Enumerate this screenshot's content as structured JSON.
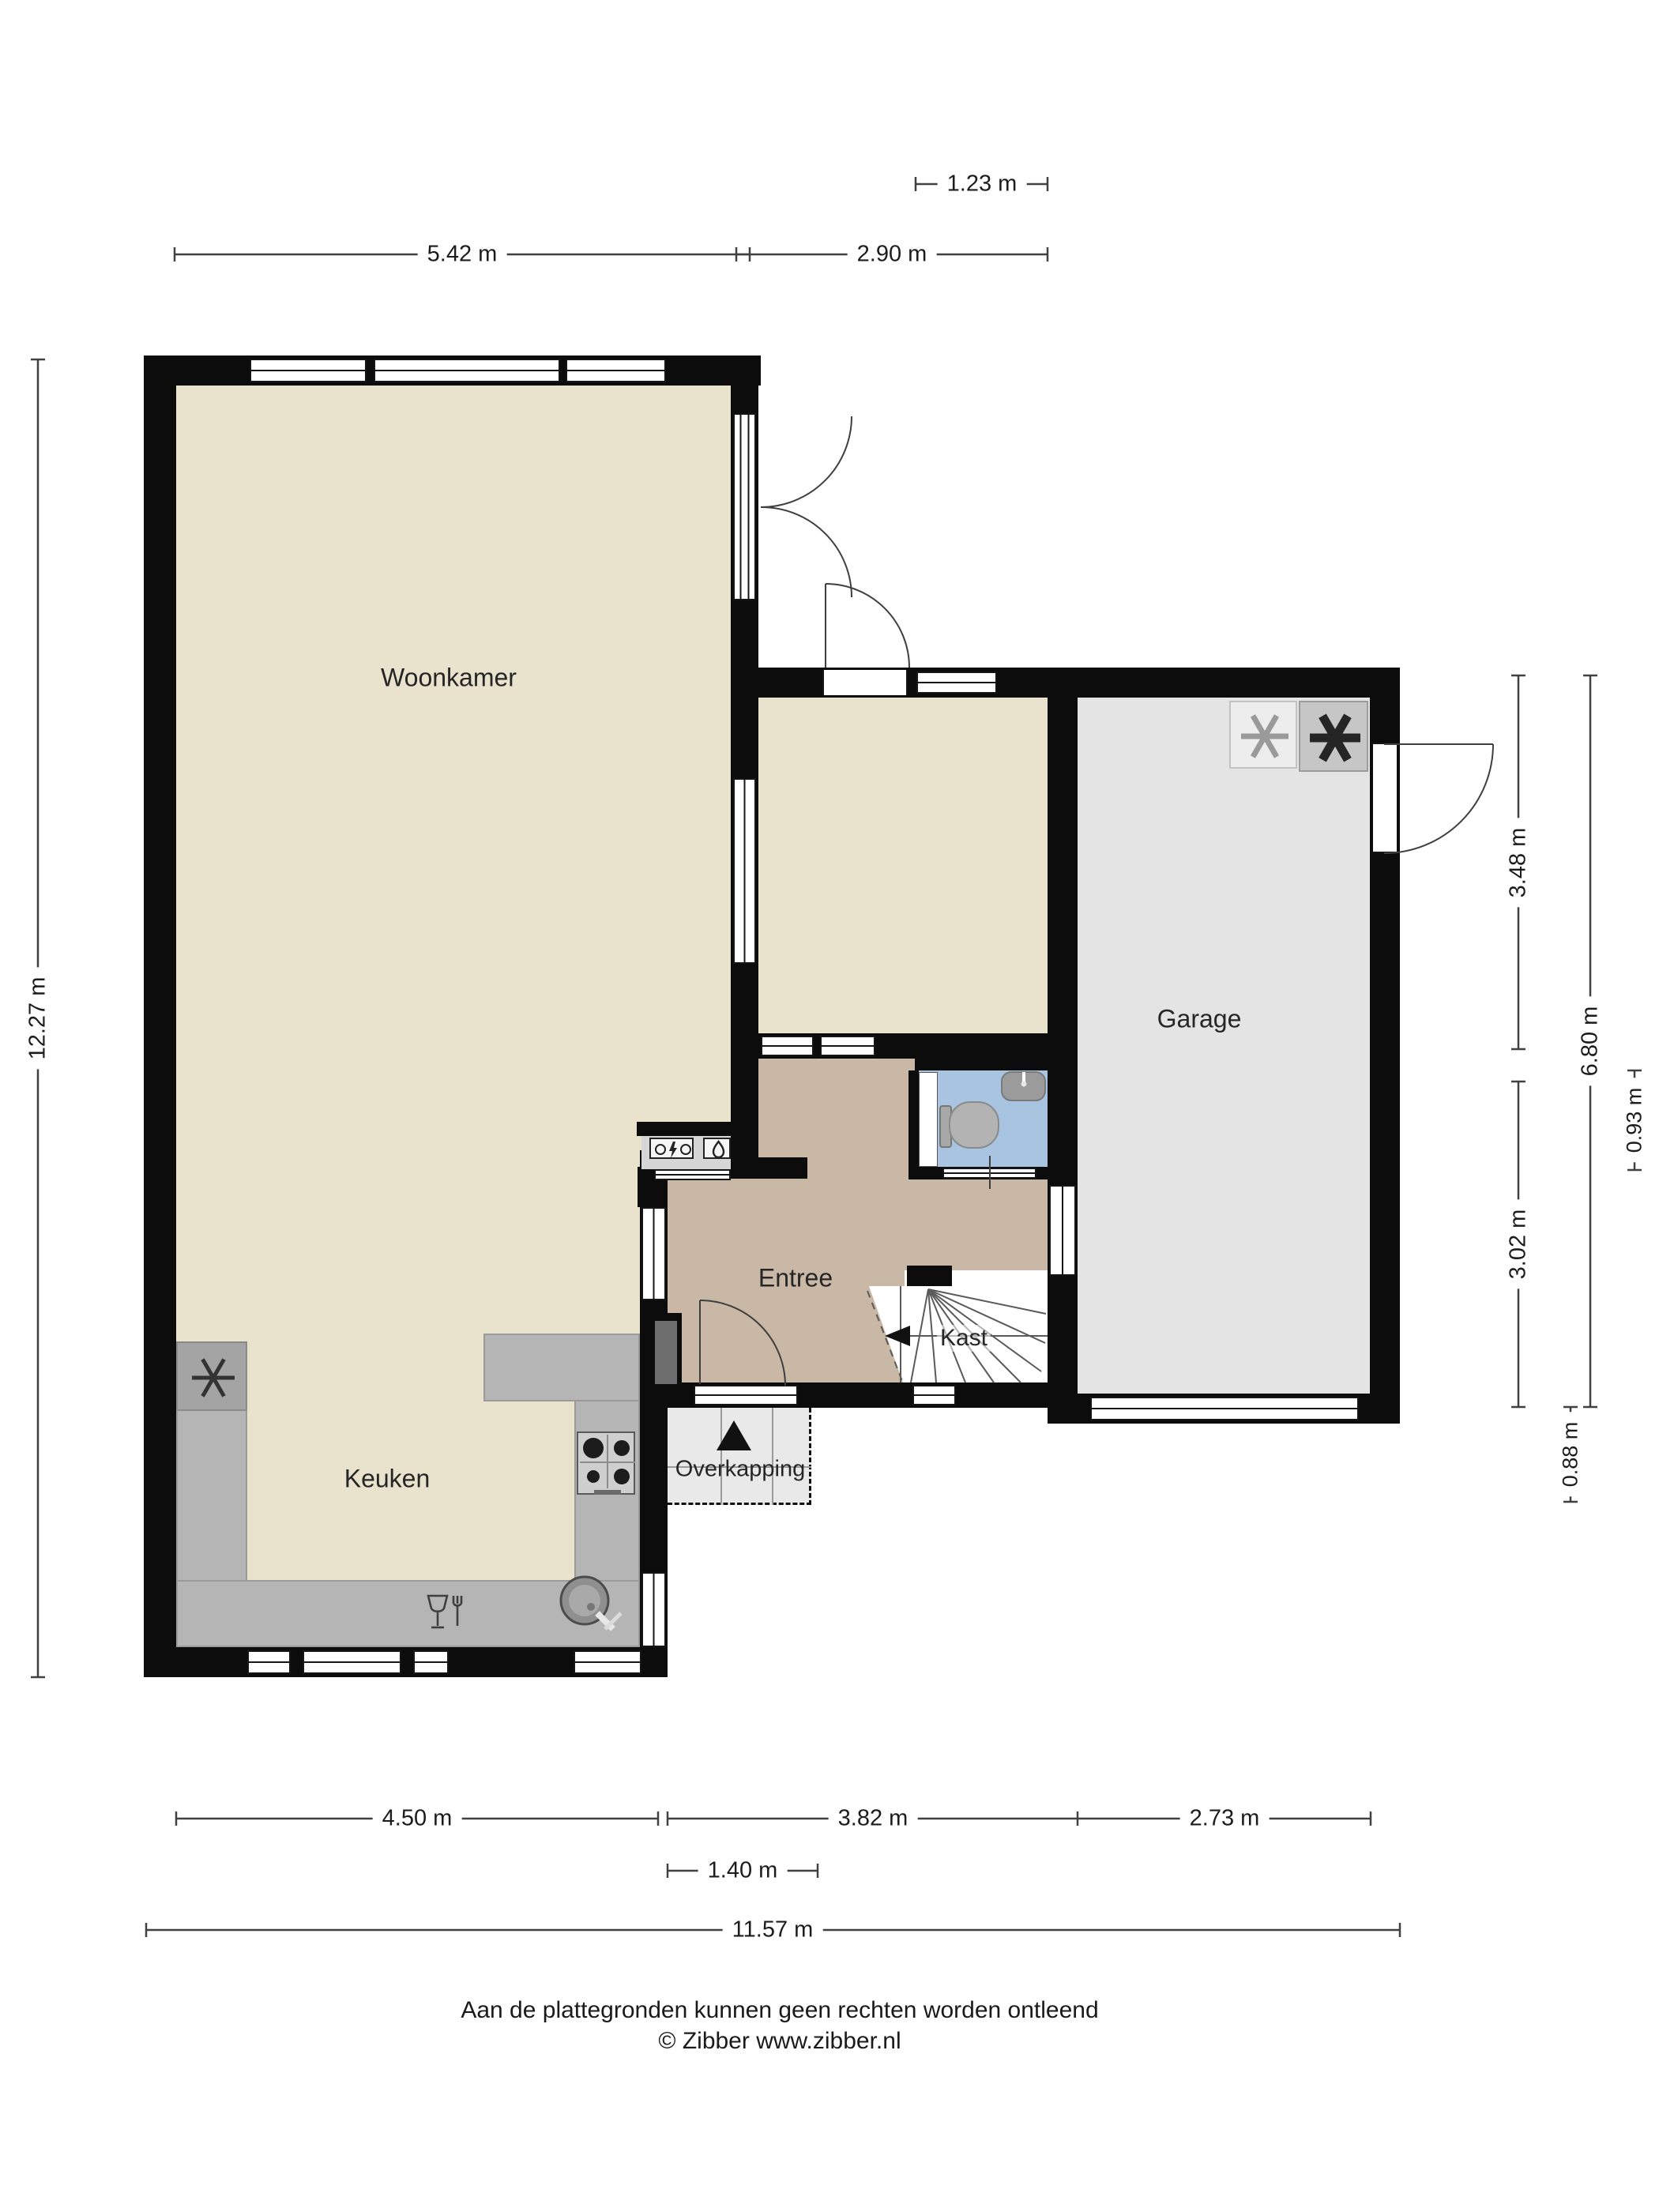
{
  "rooms": {
    "woonkamer": "Woonkamer",
    "garage": "Garage",
    "entree": "Entree",
    "kast": "Kast",
    "keuken": "Keuken",
    "overkapping": "Overkapping"
  },
  "dimensions": {
    "top_small": "1.23 m",
    "top_left": "5.42 m",
    "top_right": "2.90 m",
    "left_total": "12.27 m",
    "right_upper": "3.48 m",
    "right_lower": "3.02 m",
    "right_total": "6.80 m",
    "right_small_mid": "0.93 m",
    "right_small_bottom": "0.88 m",
    "bottom_kitchen": "4.50 m",
    "bottom_middle": "3.82 m",
    "bottom_garage": "2.73 m",
    "bottom_small": "1.40 m",
    "bottom_total": "11.57 m"
  },
  "footer": {
    "disclaimer": "Aan de plattegronden kunnen geen rechten worden ontleend",
    "copyright": "© Zibber www.zibber.nl"
  },
  "icons": {
    "washing_machine": "asterisk-thin",
    "dryer": "asterisk-bold",
    "fridge": "asterisk-thin",
    "hob": "four-burner-stove",
    "sink": "round-basin-tap",
    "dishwasher": "glass-fork",
    "toilet": "toilet-bowl",
    "hand_basin": "basin-tap",
    "electric_meter": "bolt-meter",
    "water_meter": "droplet-meter",
    "stair_direction": "left-arrow",
    "entrance": "up-triangle"
  },
  "colors": {
    "wall": "#0c0c0c",
    "living_floor": "#e9e2cc",
    "hall_floor": "#c9b8a6",
    "toilet_floor": "#a9c4e0",
    "garage_floor": "#e4e4e4",
    "counter": "#b5b5b5",
    "canopy": "#e9e9e9"
  }
}
